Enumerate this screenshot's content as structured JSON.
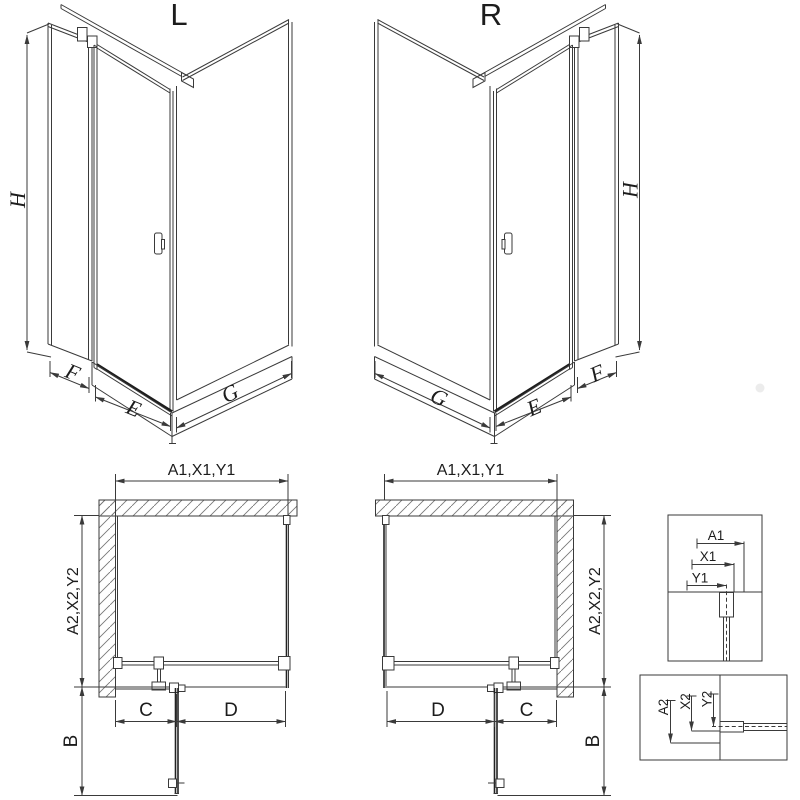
{
  "drawing": {
    "iso_left": {
      "title": "L",
      "height_dim": "H",
      "side_dim": "F",
      "door_dim": "E",
      "panel_dim": "G"
    },
    "iso_right": {
      "title": "R",
      "height_dim": "H",
      "side_dim": "F",
      "door_dim": "E",
      "panel_dim": "G"
    },
    "plan_left": {
      "width_dim": "A1,X1,Y1",
      "depth_dim": "A2,X2,Y2",
      "door_projection_dim": "B",
      "fixed_dim": "C",
      "door_dim": "D"
    },
    "plan_right": {
      "width_dim": "A1,X1,Y1",
      "depth_dim": "A2,X2,Y2",
      "door_projection_dim": "B",
      "fixed_dim": "C",
      "door_dim": "D"
    },
    "detail_width": {
      "outer": "A1",
      "mid": "X1",
      "inner": "Y1"
    },
    "detail_depth": {
      "outer": "A2",
      "mid": "X2",
      "inner": "Y2"
    },
    "colors": {
      "line": "#3a3a3a",
      "dark_line": "#1d1d1d",
      "hatch": "#777777",
      "background": "#ffffff",
      "watermark": "#eaeaea"
    }
  }
}
